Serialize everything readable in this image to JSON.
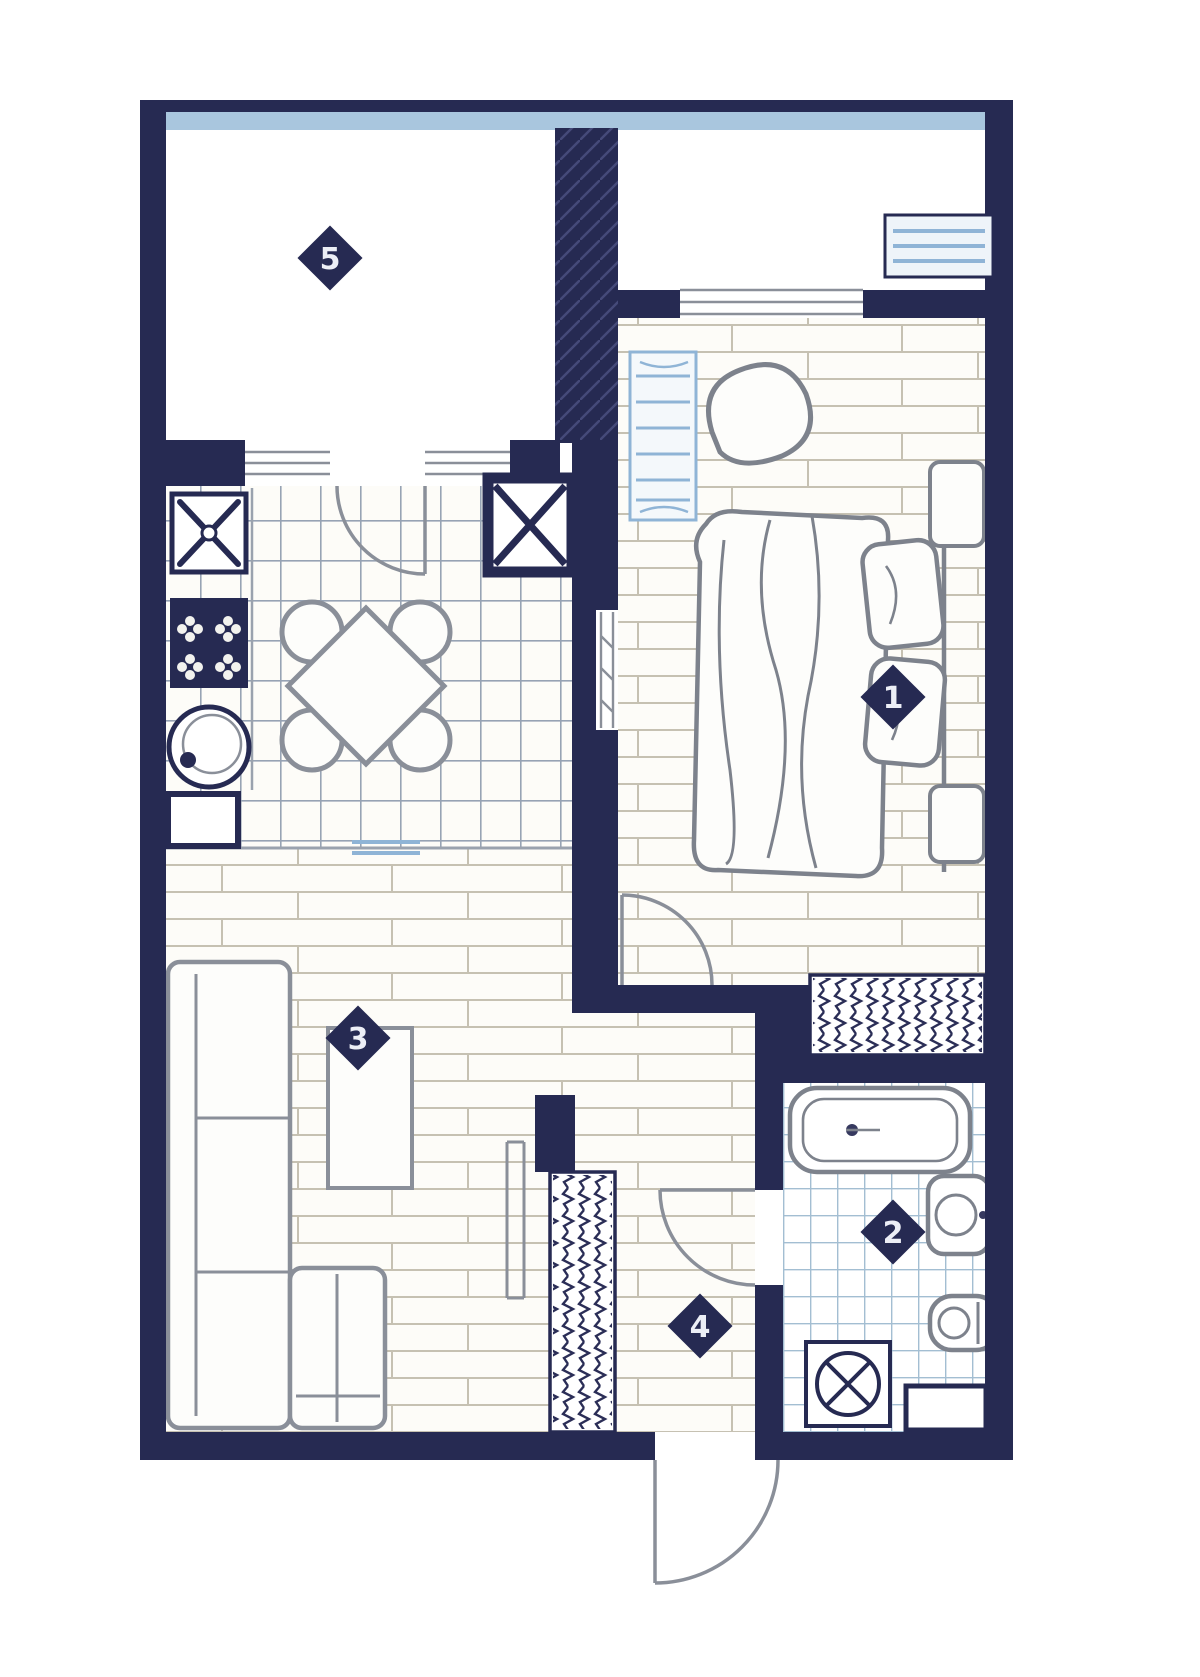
{
  "floor_plan": {
    "type": "apartment-floor-plan",
    "room_markers": [
      {
        "room": "bedroom",
        "number": "1"
      },
      {
        "room": "bathroom",
        "number": "2"
      },
      {
        "room": "living-room",
        "number": "3"
      },
      {
        "room": "hallway",
        "number": "4"
      },
      {
        "room": "balcony",
        "number": "5"
      }
    ],
    "fixtures": [
      "air-conditioner",
      "radiator",
      "armchair",
      "bed",
      "pillows",
      "nightstand",
      "wardrobe-hangers",
      "ventilation-shaft",
      "hob",
      "stove",
      "kitchen-sink",
      "base-cabinet",
      "dining-table",
      "chairs",
      "sofa",
      "coffee-table",
      "hall-wardrobe-hangers",
      "bathtub",
      "wash-basin",
      "toilet",
      "washing-machine",
      "bathroom-cabinet",
      "entrance-door",
      "balcony-door",
      "bedroom-door",
      "bathroom-door"
    ],
    "colors": {
      "wall": "#262a52",
      "glazing_blue": "#a9c6de",
      "radiator_blue": "#8fb4d6",
      "furniture_line": "#7d828c",
      "plank_line": "#c6c1b2",
      "kitchen_tile_line": "#97a3b4",
      "bath_tile_line": "#a3bed2",
      "floor": "#fdfcf8"
    }
  }
}
